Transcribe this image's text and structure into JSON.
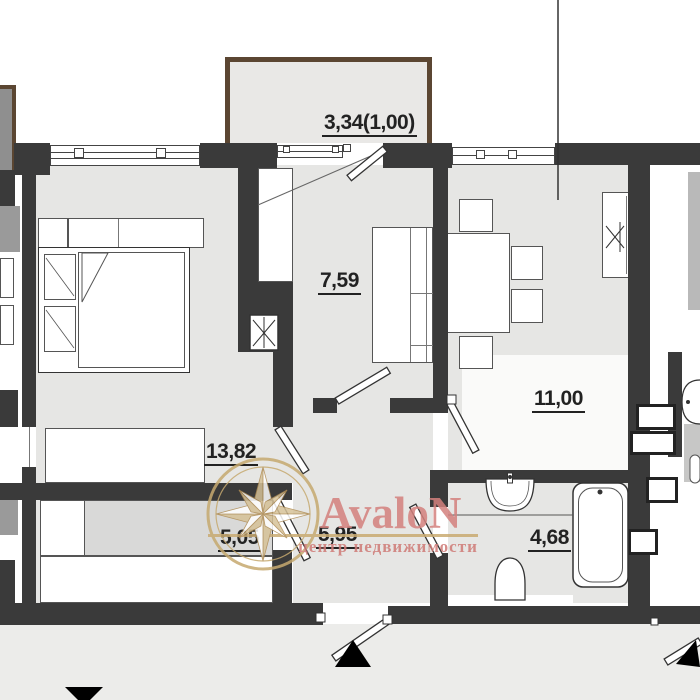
{
  "plan": {
    "type": "apartment floor plan",
    "rooms": [
      {
        "id": "balcony",
        "area_label": "3,34(1,00)"
      },
      {
        "id": "kitchen",
        "area_label": "7,59"
      },
      {
        "id": "living_room",
        "area_label": "11,00"
      },
      {
        "id": "bedroom",
        "area_label": "13,82"
      },
      {
        "id": "wardrobe",
        "area_label": "5,05"
      },
      {
        "id": "hallway",
        "area_label": "5,95"
      },
      {
        "id": "bathroom",
        "area_label": "4,68"
      }
    ]
  },
  "watermark": {
    "brand": "AvaloN",
    "tagline": "центр недвижимости",
    "brand_color": "#d4817d",
    "accent_color": "#c9ab72"
  },
  "colors": {
    "wall": "#3a3a3a",
    "room_fill": "#e6e6e4",
    "balcony_border": "#5b4632",
    "ground": "#ececea"
  }
}
